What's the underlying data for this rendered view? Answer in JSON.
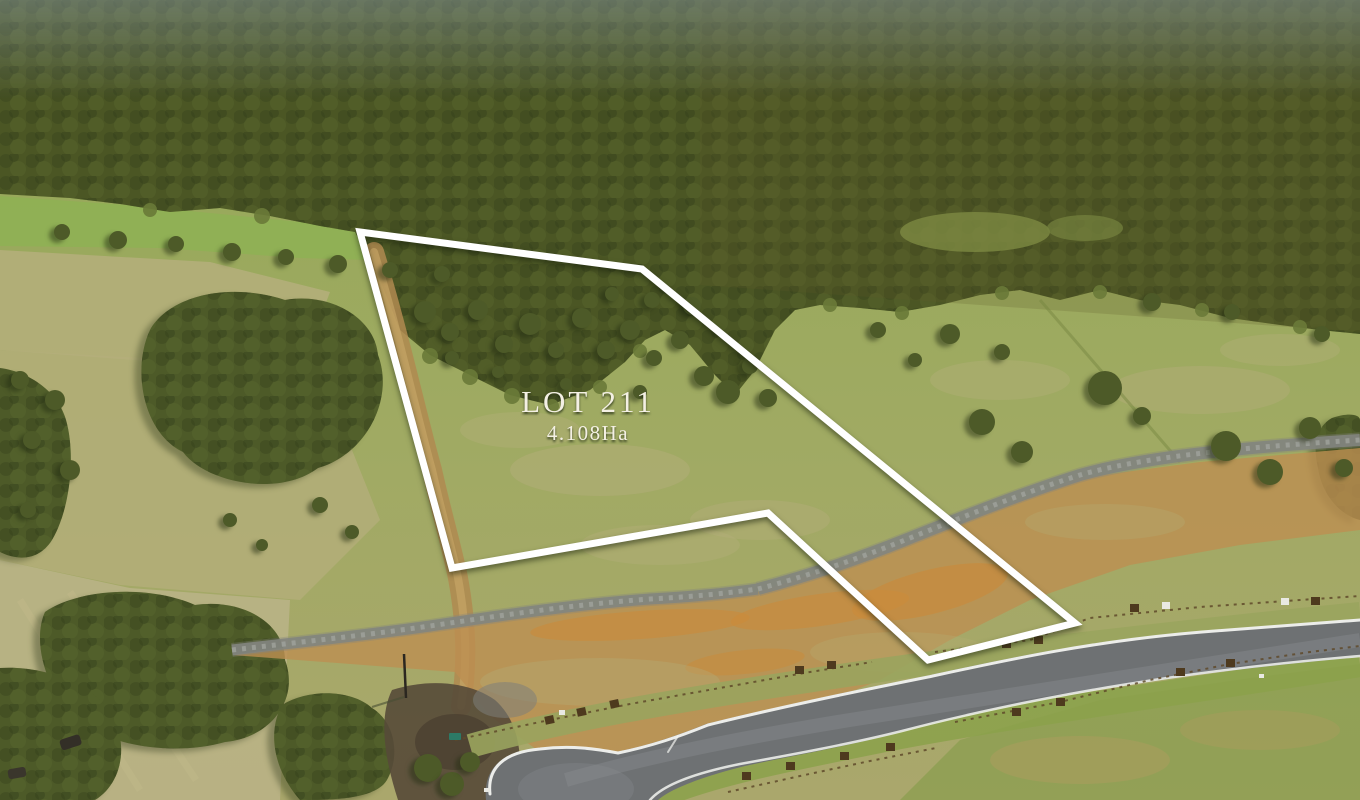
{
  "image": {
    "type": "aerial-photograph",
    "subject": "Vacant rural land parcel marked for sale, bushland behind, subdivision road and cul-de-sac in foreground"
  },
  "overlay": {
    "lot_label": "LOT 211",
    "area_label": "4.108Ha"
  },
  "palette": {
    "forest": "#4b5624",
    "grove": "#4d5a28",
    "grass": "#97aa57",
    "grass_bright": "#8fb054",
    "grass_pale": "#b4ae7a",
    "dirt": "#bd8f51",
    "dirt_orange": "#cc8a38",
    "gravel": "#83857f",
    "road": "#6e7173",
    "road_line": "#f2f3f0",
    "fence": "#5f4a2a",
    "boundary": "#ffffff",
    "label_text": "#f4f0e4"
  }
}
